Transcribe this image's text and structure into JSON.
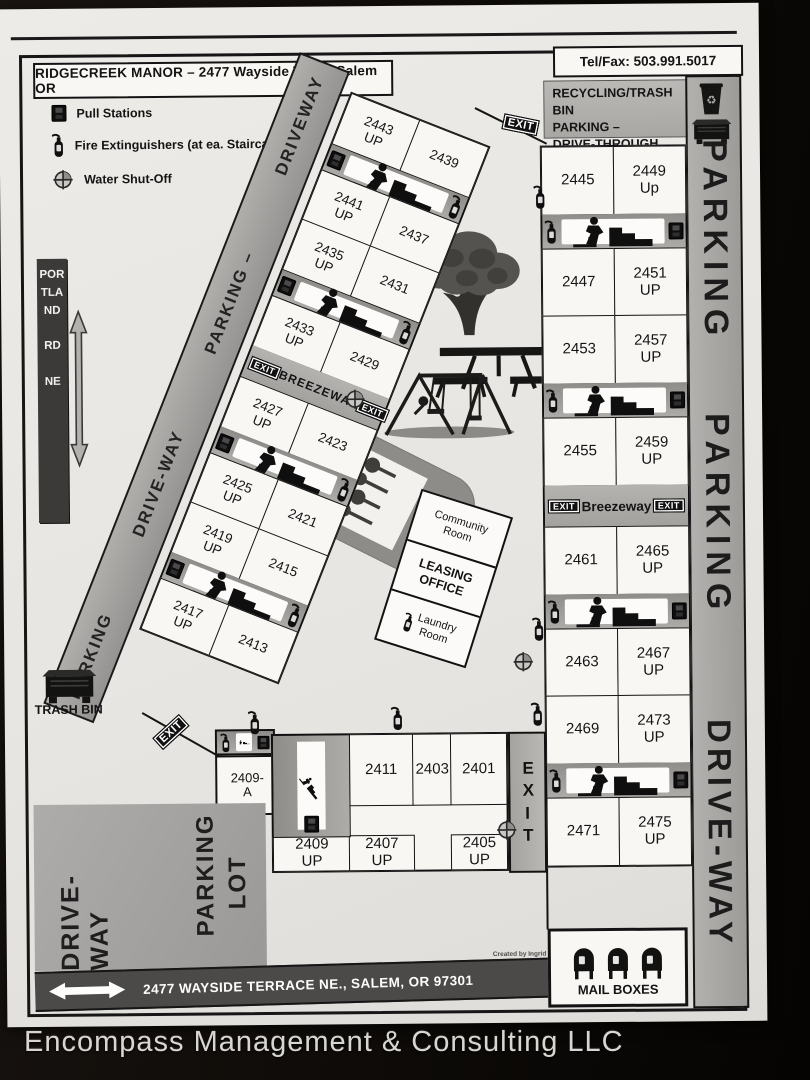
{
  "header": {
    "title": "RIDGECREEK MANOR – 2477 Wayside Tr. NE  Salem OR",
    "telfax": "Tel/Fax:  503.991.5017"
  },
  "legend": {
    "pull": "Pull Stations",
    "fire": "Fire Extinguishers (at ea. Staircase)",
    "water": "Water Shut-Off"
  },
  "signs": {
    "recycling": "RECYCLING/TRASH BIN\nPARKING –\nDRIVE-THROUGH",
    "portland": "PORTLAND\n\nRD\n\nNE",
    "trash_bin": "TRASH BIN",
    "exit": "EXIT",
    "breezeway_nw": "BREEZEWAY",
    "breezeway_e": "Breezeway",
    "street": "2477 WAYSIDE TERRACE NE., SALEM, OR 97301",
    "mail_boxes": "MAIL BOXES",
    "credit": "Created by Ingrid"
  },
  "roads": {
    "nw_strip": [
      "DRIVEWAY",
      "PARKING –",
      "DRIVE-WAY",
      "PARKING"
    ],
    "east_strip": [
      "PARKING",
      "PARKING",
      "DRIVE-WAY"
    ],
    "sw_driveway": "DRIVE-WAY",
    "parking_lot_1": "PARKING",
    "parking_lot_2": "LOT"
  },
  "office": {
    "community": "Community\nRoom",
    "leasing": "LEASING\nOFFICE",
    "laundry": "Laundry\nRoom"
  },
  "units": {
    "nw": [
      [
        "2443\nUP",
        "2439"
      ],
      [
        "2441\nUP",
        "2437"
      ],
      [
        "2435\nUP",
        "2431"
      ],
      [
        "2433\nUP",
        "2429"
      ],
      [
        "2427\nUP",
        "2423"
      ],
      [
        "2425\nUP",
        "2421"
      ],
      [
        "2419\nUP",
        "2415"
      ],
      [
        "2417\nUP",
        "2413"
      ]
    ],
    "east": [
      [
        "2445",
        "2449\nUp"
      ],
      [
        "2447",
        "2451\nUP"
      ],
      [
        "2453",
        "2457\nUP"
      ],
      [
        "2455",
        "2459\nUP"
      ],
      [
        "2461",
        "2465\nUP"
      ],
      [
        "2463",
        "2467\nUP"
      ],
      [
        "2469",
        "2473\nUP"
      ],
      [
        "2471",
        "2475\nUP"
      ]
    ],
    "south_top": [
      "2411",
      "2403",
      "2401"
    ],
    "south_bottom": [
      "2409\nUP",
      "2407\nUP",
      "2405\nUP"
    ],
    "annex": "2409-\nA"
  },
  "footer": {
    "company": "Encompass Management & Consulting LLC"
  }
}
